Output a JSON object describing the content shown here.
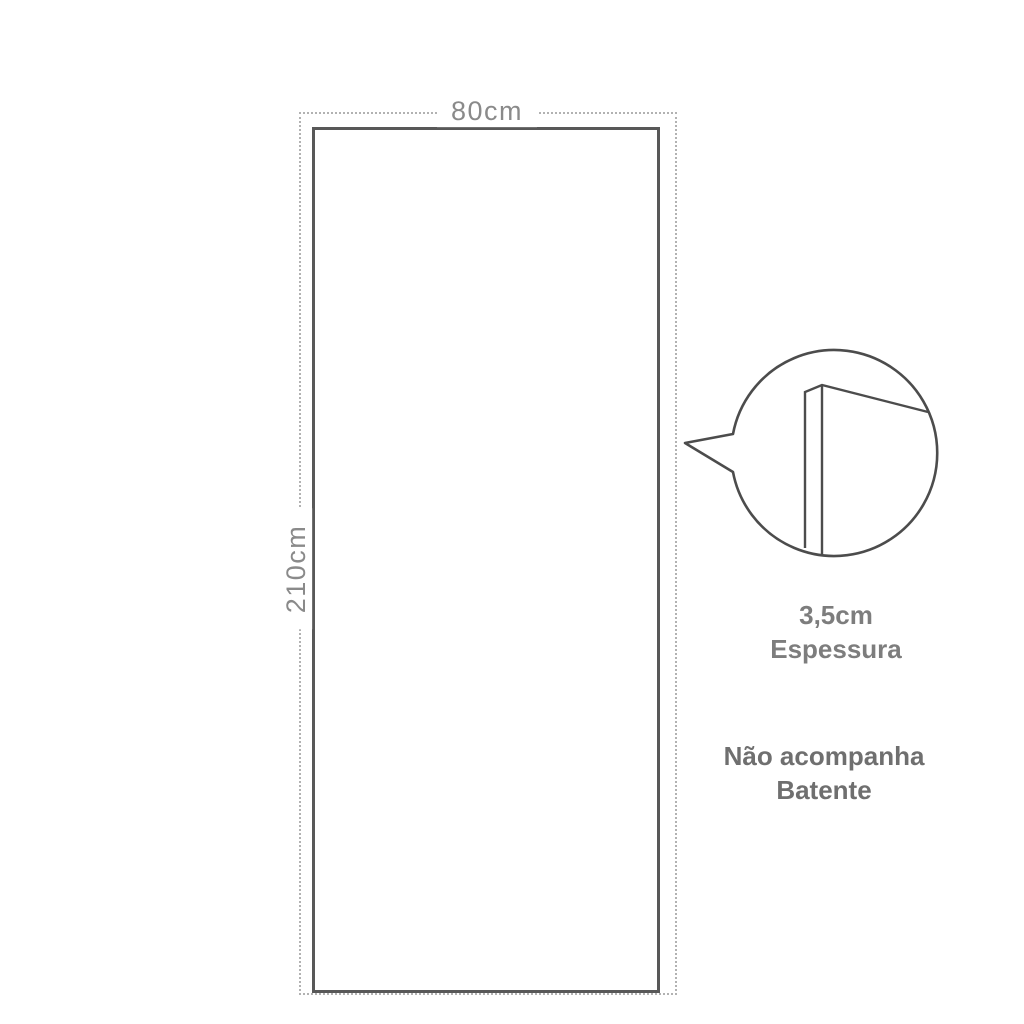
{
  "diagram": {
    "door": {
      "width_label": "80cm",
      "height_label": "210cm"
    },
    "thickness": {
      "value": "3,5cm",
      "label": "Espessura"
    },
    "note": {
      "line1": "Não acompanha",
      "line2": "Batente"
    },
    "colors": {
      "outline": "#4c4c4c",
      "door_border": "#585858",
      "dashed_line": "#b2b2b2",
      "dimension_text": "#8a8a8a",
      "annotation_text": "#6f6f6f",
      "background": "#ffffff"
    }
  }
}
